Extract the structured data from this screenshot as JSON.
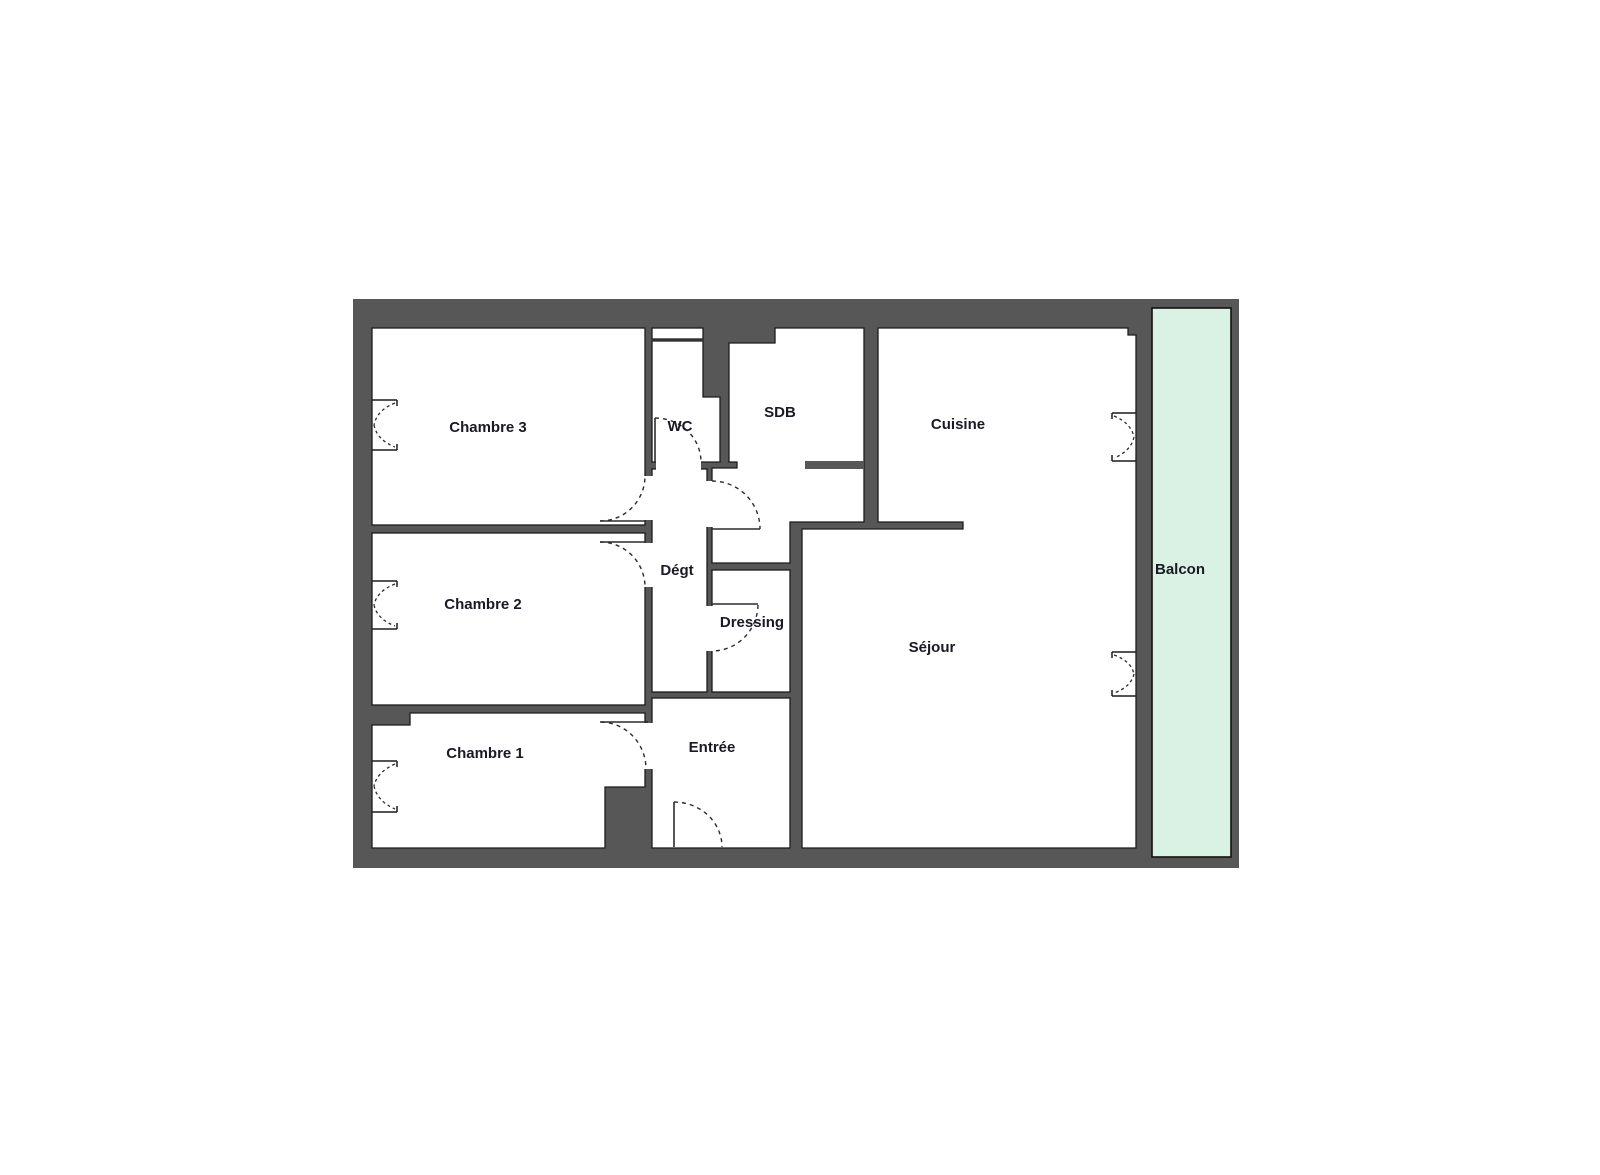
{
  "colors": {
    "wall": "#575757",
    "room": "#ffffff",
    "balcony": "#d9f2e3",
    "label": "#1a1a24"
  },
  "rooms": [
    {
      "id": "chambre3",
      "label": "Chambre 3"
    },
    {
      "id": "chambre2",
      "label": "Chambre 2"
    },
    {
      "id": "chambre1",
      "label": "Chambre 1"
    },
    {
      "id": "wc",
      "label": "WC"
    },
    {
      "id": "sdb",
      "label": "SDB"
    },
    {
      "id": "degt",
      "label": "Dégt"
    },
    {
      "id": "dressing",
      "label": "Dressing"
    },
    {
      "id": "entree",
      "label": "Entrée"
    },
    {
      "id": "cuisine",
      "label": "Cuisine"
    },
    {
      "id": "sejour",
      "label": "Séjour"
    },
    {
      "id": "balcon",
      "label": "Balcon"
    }
  ]
}
